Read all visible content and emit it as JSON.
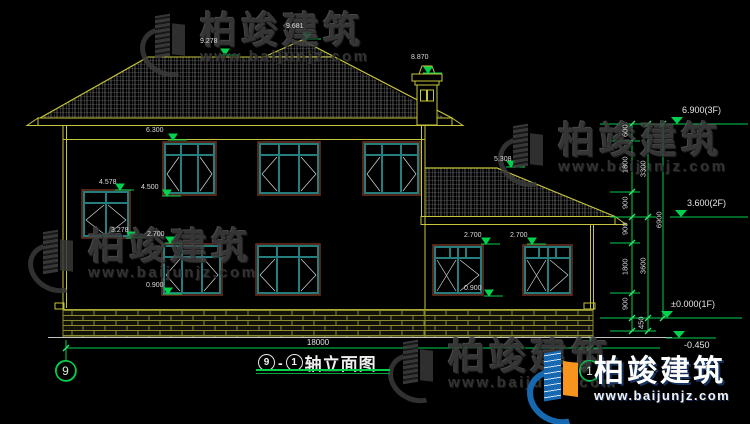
{
  "title": {
    "axis_a": "9",
    "dash": "-",
    "axis_b": "1",
    "name": "轴立面图"
  },
  "axes": {
    "left_bubble": "9",
    "right_bubble": "1"
  },
  "dimensions": {
    "overall_width": "18000",
    "col1": [
      "600",
      "1800",
      "900",
      "900",
      "1800",
      "900"
    ],
    "col1_bottom": "450",
    "col2": [
      "3300",
      "3600"
    ],
    "total_height": "6900"
  },
  "level_markers": [
    {
      "label": "6.900(3F)"
    },
    {
      "label": "3.600(2F)"
    },
    {
      "label": "±0.000(1F)"
    },
    {
      "label": "-0.450"
    }
  ],
  "spot_elevations": {
    "ridge": "9.278",
    "peak": "9.681",
    "chimney": "8.870",
    "lintel_2f": "6.300",
    "stair_win_top": "4.578",
    "sill_2f": "4.500",
    "stair_win_bottom": "3.278",
    "win_1f_top": "2.700",
    "win_1f_sill": "0.900",
    "annex_ridge": "5.308",
    "annex_win1_top": "2.700",
    "annex_win2_top": "2.700",
    "annex_win_sill": "0.900"
  },
  "watermark": {
    "brand": "柏竣建筑",
    "url": "www.baijunjz.com"
  },
  "colors": {
    "line_yellow": "#c6c63c",
    "dim_green": "#00d24e",
    "window_teal": "#267d7d",
    "window_frame": "#6f3322",
    "logo_blue": "#1668b0",
    "logo_orange": "#f7941d"
  }
}
